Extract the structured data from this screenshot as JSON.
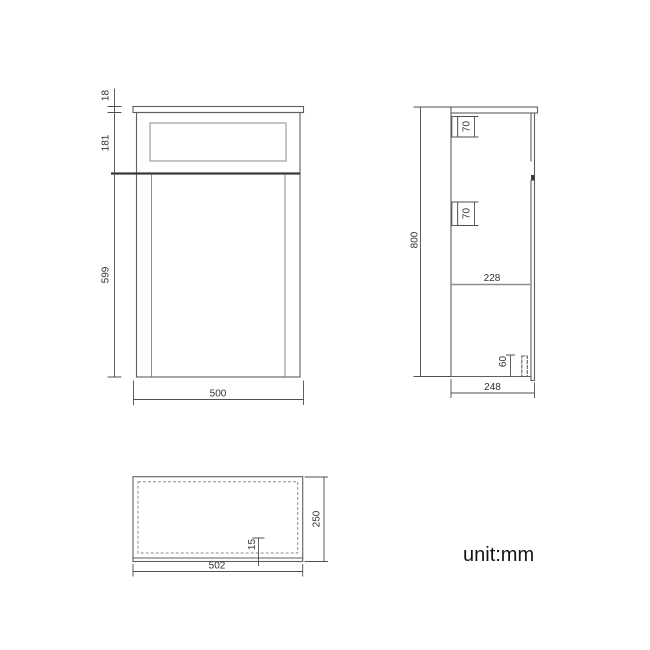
{
  "unit_label": "unit:mm",
  "colors": {
    "line": "#5f5f5f",
    "line-light": "#8d8d8d",
    "line-dark": "#3a3a3a",
    "dim": "#4f4f4f",
    "text": "#333333"
  },
  "views": {
    "front": {
      "dims": {
        "counter_thickness": "18",
        "drawer_front_height": "181",
        "door_height": "599",
        "overall_width": "500"
      }
    },
    "side": {
      "dims": {
        "upper_bracket": "70",
        "lower_bracket": "70",
        "overall_height": "800",
        "interior_depth": "228",
        "plinth_height": "60",
        "overall_depth": "248"
      }
    },
    "plan": {
      "dims": {
        "overall_depth": "250",
        "front_rail": "15",
        "overall_width": "502"
      }
    }
  }
}
